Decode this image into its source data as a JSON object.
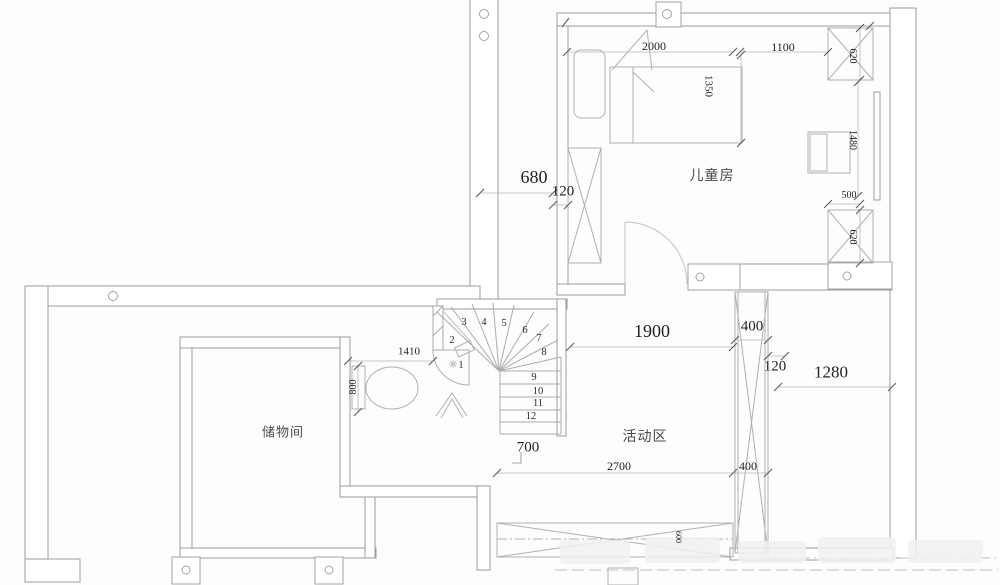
{
  "rooms": {
    "childrens_room": "儿童房",
    "activity_area": "活动区",
    "storage_room": "储物间"
  },
  "dims": {
    "d2000": "2000",
    "d1100": "1100",
    "d1350": "1350",
    "d620a": "620",
    "d1480": "1480",
    "d500": "500",
    "d620b": "620",
    "d680": "680",
    "d120a": "120",
    "d1410": "1410",
    "d800": "800",
    "d1900": "1900",
    "d400a": "400",
    "d120b": "120",
    "d1280": "1280",
    "d700": "700",
    "d2700": "2700",
    "d400b": "400",
    "d600": "600"
  },
  "stairs": {
    "steps": [
      "1",
      "2",
      "3",
      "4",
      "5",
      "6",
      "7",
      "8",
      "9",
      "10",
      "11",
      "12"
    ]
  },
  "colors": {
    "wall_line": "#9b9b9b",
    "furniture_line": "#b0b0b0",
    "dim_line": "#b5b5b5",
    "tick": "#5a5a5a",
    "text": "#1f1f1f"
  }
}
